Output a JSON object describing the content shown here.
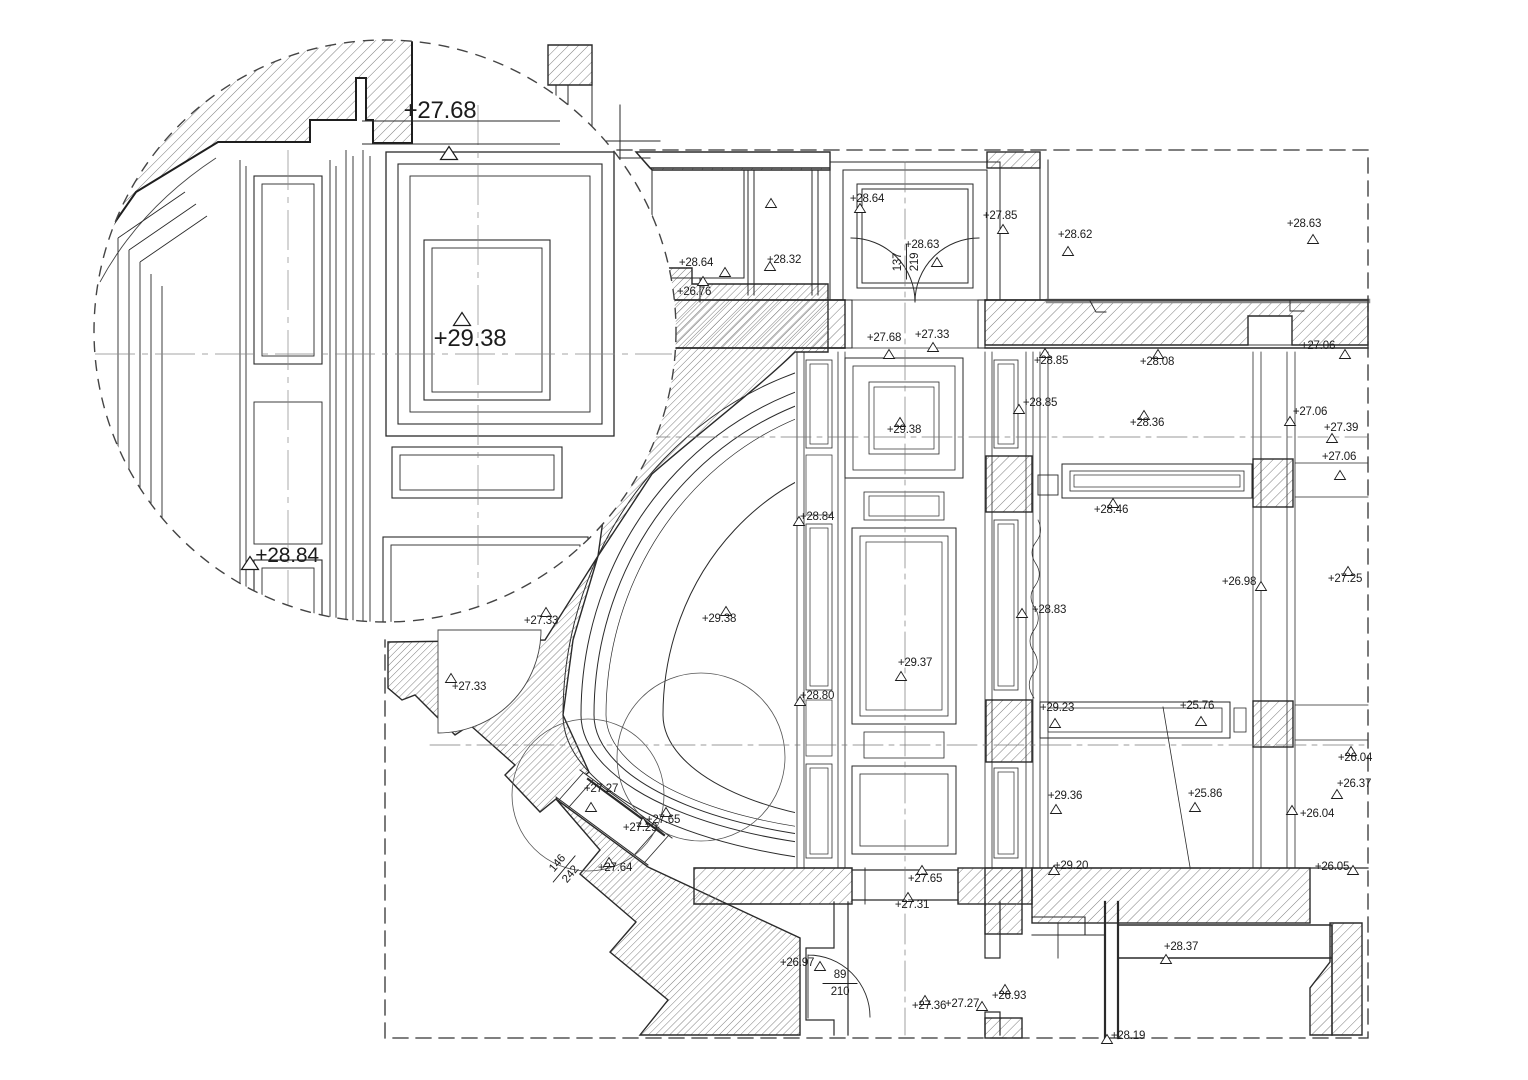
{
  "drawing": {
    "description": "architectural reflected ceiling plan with spot elevations and magnified detail circle",
    "colors": {
      "line": "#2a2a2a",
      "hatch": "#6e6e6e",
      "thick_gray": "#8a8a8a",
      "background": "#ffffff"
    },
    "detail_view": {
      "markers": [
        {
          "label": "+27.68",
          "tx": 440,
          "ty": 118,
          "mx": 449,
          "my": 153,
          "fs": 24
        },
        {
          "label": "+29.38",
          "tx": 470,
          "ty": 346,
          "mx": 462,
          "my": 319,
          "fs": 24
        },
        {
          "label": "+28.84",
          "tx": 287,
          "ty": 562,
          "mx": 250,
          "my": 563,
          "fs": 21
        }
      ]
    },
    "plan": {
      "markers": [
        {
          "label": "+28.64",
          "tx": 696,
          "ty": 266,
          "mx": 725,
          "my": 272
        },
        {
          "label": "+26.76",
          "tx": 694,
          "ty": 295,
          "mx": 703,
          "my": 281
        },
        {
          "label": "+28.32",
          "tx": 784,
          "ty": 263,
          "mx": 770,
          "my": 266
        },
        {
          "label": "",
          "tx": 0,
          "ty": 0,
          "mx": 771,
          "my": 203
        },
        {
          "label": "+28.64",
          "tx": 867,
          "ty": 202,
          "mx": 860,
          "my": 208
        },
        {
          "label": "+28.63",
          "tx": 922,
          "ty": 248,
          "mx": 937,
          "my": 262
        },
        {
          "label": "+27.85",
          "tx": 1000,
          "ty": 219,
          "mx": 1003,
          "my": 229
        },
        {
          "label": "+28.62",
          "tx": 1075,
          "ty": 238,
          "mx": 1068,
          "my": 251
        },
        {
          "label": "+28.63",
          "tx": 1304,
          "ty": 227,
          "mx": 1313,
          "my": 239
        },
        {
          "label": "+27.68",
          "tx": 884,
          "ty": 341,
          "mx": 889,
          "my": 354
        },
        {
          "label": "+27.33",
          "tx": 932,
          "ty": 338,
          "mx": 933,
          "my": 347
        },
        {
          "label": "+28.85",
          "tx": 1051,
          "ty": 364,
          "mx": 1045,
          "my": 353
        },
        {
          "label": "+28.08",
          "tx": 1157,
          "ty": 365,
          "mx": 1158,
          "my": 354
        },
        {
          "label": "+27.06",
          "tx": 1318,
          "ty": 349,
          "mx": 1345,
          "my": 354
        },
        {
          "label": "+28.85",
          "tx": 1040,
          "ty": 406,
          "mx": 1019,
          "my": 409
        },
        {
          "label": "+28.36",
          "tx": 1147,
          "ty": 426,
          "mx": 1144,
          "my": 415
        },
        {
          "label": "+27.06",
          "tx": 1310,
          "ty": 415,
          "mx": 1290,
          "my": 421
        },
        {
          "label": "+27.39",
          "tx": 1341,
          "ty": 431,
          "mx": 1332,
          "my": 438
        },
        {
          "label": "+27.06",
          "tx": 1339,
          "ty": 460,
          "mx": 1340,
          "my": 475
        },
        {
          "label": "+29.38",
          "tx": 904,
          "ty": 433,
          "mx": 900,
          "my": 422
        },
        {
          "label": "+28.84",
          "tx": 817,
          "ty": 520,
          "mx": 799,
          "my": 521
        },
        {
          "label": "+28.46",
          "tx": 1111,
          "ty": 513,
          "mx": 1113,
          "my": 503
        },
        {
          "label": "+29.38",
          "tx": 719,
          "ty": 622,
          "mx": 726,
          "my": 611
        },
        {
          "label": "+27.33",
          "tx": 541,
          "ty": 624,
          "mx": 546,
          "my": 612
        },
        {
          "label": "+27.33",
          "tx": 469,
          "ty": 690,
          "mx": 451,
          "my": 678
        },
        {
          "label": "+28.83",
          "tx": 1049,
          "ty": 613,
          "mx": 1022,
          "my": 613
        },
        {
          "label": "+26.98",
          "tx": 1239,
          "ty": 585,
          "mx": 1261,
          "my": 586
        },
        {
          "label": "+27.25",
          "tx": 1345,
          "ty": 582,
          "mx": 1348,
          "my": 571
        },
        {
          "label": "+29.37",
          "tx": 915,
          "ty": 666,
          "mx": 901,
          "my": 676
        },
        {
          "label": "+28.80",
          "tx": 817,
          "ty": 699,
          "mx": 800,
          "my": 701
        },
        {
          "label": "+29.23",
          "tx": 1057,
          "ty": 711,
          "mx": 1055,
          "my": 723
        },
        {
          "label": "+25.76",
          "tx": 1197,
          "ty": 709,
          "mx": 1201,
          "my": 721
        },
        {
          "label": "+26.04",
          "tx": 1355,
          "ty": 761,
          "mx": 1351,
          "my": 751
        },
        {
          "label": "+26.37",
          "tx": 1354,
          "ty": 787,
          "mx": 1337,
          "my": 794
        },
        {
          "label": "+29.36",
          "tx": 1065,
          "ty": 799,
          "mx": 1056,
          "my": 809
        },
        {
          "label": "+25.86",
          "tx": 1205,
          "ty": 797,
          "mx": 1195,
          "my": 807
        },
        {
          "label": "+26.04",
          "tx": 1317,
          "ty": 817,
          "mx": 1292,
          "my": 810
        },
        {
          "label": "+29.20",
          "tx": 1071,
          "ty": 869,
          "mx": 1054,
          "my": 870
        },
        {
          "label": "+26.05",
          "tx": 1332,
          "ty": 870,
          "mx": 1353,
          "my": 870
        },
        {
          "label": "+27.27",
          "tx": 601,
          "ty": 792,
          "mx": 591,
          "my": 807
        },
        {
          "label": "+27.65",
          "tx": 663,
          "ty": 823,
          "mx": 666,
          "my": 812
        },
        {
          "label": "+27.29",
          "tx": 640,
          "ty": 831,
          "mx": 643,
          "my": 822
        },
        {
          "label": "+27.64",
          "tx": 615,
          "ty": 871,
          "mx": 609,
          "my": 862
        },
        {
          "label": "+26.97",
          "tx": 797,
          "ty": 966,
          "mx": 820,
          "my": 966
        },
        {
          "label": "+27.65",
          "tx": 925,
          "ty": 882,
          "mx": 922,
          "my": 870
        },
        {
          "label": "+27.31",
          "tx": 912,
          "ty": 908,
          "mx": 908,
          "my": 897
        },
        {
          "label": "+27.36",
          "tx": 929,
          "ty": 1009,
          "mx": 925,
          "my": 1000
        },
        {
          "label": "+27.27",
          "tx": 962,
          "ty": 1007,
          "mx": 982,
          "my": 1006
        },
        {
          "label": "+26.93",
          "tx": 1009,
          "ty": 999,
          "mx": 1005,
          "my": 989
        },
        {
          "label": "+28.37",
          "tx": 1181,
          "ty": 950,
          "mx": 1166,
          "my": 959
        },
        {
          "label": "+28.19",
          "tx": 1128,
          "ty": 1039,
          "mx": 1107,
          "my": 1039
        }
      ]
    },
    "door_dimensions": [
      {
        "num": "137",
        "den": "219",
        "x": 905,
        "y": 262,
        "rot": -90,
        "bar": true
      },
      {
        "num": "146",
        "den": "242",
        "x": 563,
        "y": 868,
        "rot": -50,
        "bar": true
      },
      {
        "num": "89",
        "den": "210",
        "x": 840,
        "y": 982,
        "rot": 0,
        "bar": true
      }
    ]
  }
}
